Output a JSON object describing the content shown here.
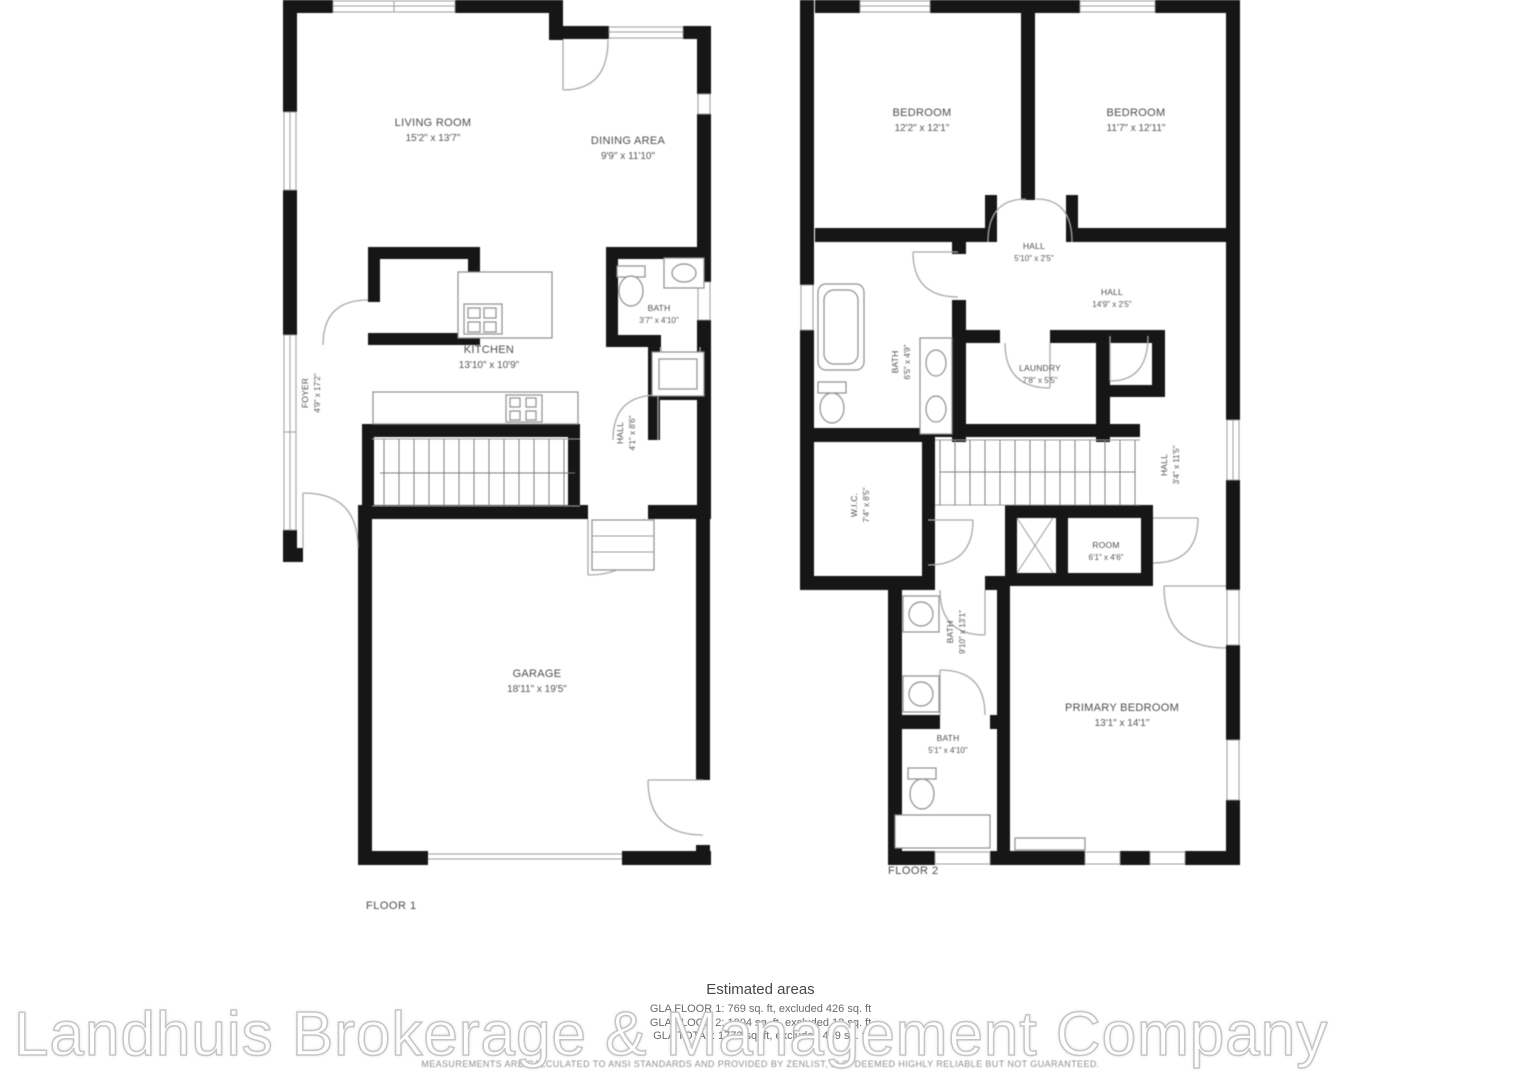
{
  "watermark": "Landhuis Brokerage & Management Company",
  "floor1": {
    "caption": "FLOOR 1",
    "rooms": {
      "living": {
        "name": "LIVING ROOM",
        "dims": "15'2\" x 13'7\""
      },
      "dining": {
        "name": "DINING AREA",
        "dims": "9'9\" x 11'10\""
      },
      "kitchen": {
        "name": "KITCHEN",
        "dims": "13'10\" x 10'9\""
      },
      "bath": {
        "name": "BATH",
        "dims": "3'7\" x 4'10\""
      },
      "foyer": {
        "name": "FOYER",
        "dims": "4'9\" x 17'2\""
      },
      "hall": {
        "name": "HALL",
        "dims": "4'1\" x 8'6\""
      },
      "garage": {
        "name": "GARAGE",
        "dims": "18'11\" x 19'5\""
      }
    }
  },
  "floor2": {
    "caption": "FLOOR 2",
    "rooms": {
      "bedroom_left": {
        "name": "BEDROOM",
        "dims": "12'2\" x 12'1\""
      },
      "bedroom_right": {
        "name": "BEDROOM",
        "dims": "11'7\" x 12'11\""
      },
      "hall_upper": {
        "name": "HALL",
        "dims": "5'10\" x 2'5\""
      },
      "hall_main": {
        "name": "HALL",
        "dims": "14'9\" x 2'5\""
      },
      "bath_left": {
        "name": "BATH",
        "dims": "6'5\" x 4'9\""
      },
      "laundry": {
        "name": "LAUNDRY",
        "dims": "7'8\" x 5'5\""
      },
      "wic": {
        "name": "W.I.C.",
        "dims": "7'4\" x 8'5\""
      },
      "hall_right": {
        "name": "HALL",
        "dims": "3'4\" x 11'5\""
      },
      "room": {
        "name": "ROOM",
        "dims": "6'1\" x 4'6\""
      },
      "bath_middle": {
        "name": "BATH",
        "dims": "9'10\" x 13'1\""
      },
      "bath_lower": {
        "name": "BATH",
        "dims": "5'1\" x 4'10\""
      },
      "primary": {
        "name": "PRIMARY BEDROOM",
        "dims": "13'1\" x 14'1\""
      }
    }
  },
  "footer": {
    "title": "Estimated areas",
    "lines": [
      "GLA FLOOR 1: 769 sq. ft, excluded 426 sq. ft",
      "GLA FLOOR 2: 1004 sq. ft, excluded 13 sq. ft",
      "GLA TOTAL: 1773 sq. ft, excluded 439 sq. ft"
    ],
    "disclaimer": "MEASUREMENTS ARE CALCULATED TO ANSI STANDARDS AND PROVIDED BY ZENLIST, LLC. DEEMED HIGHLY RELIABLE BUT NOT GUARANTEED."
  }
}
